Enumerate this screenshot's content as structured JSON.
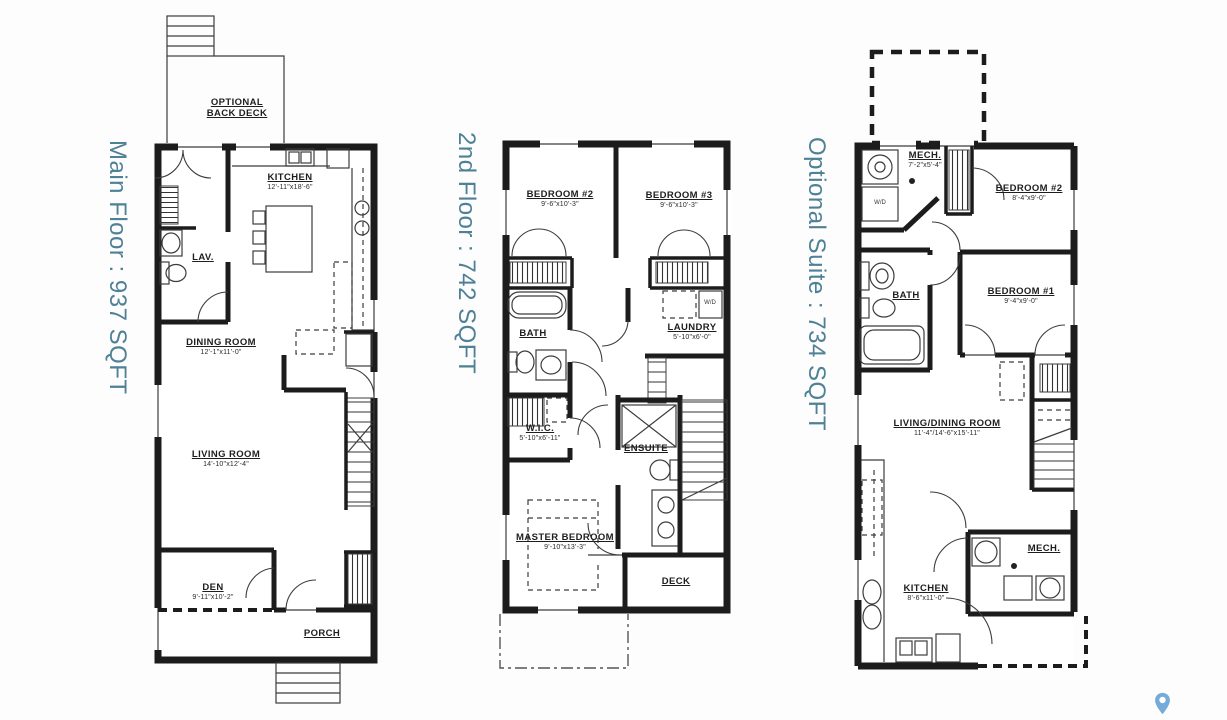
{
  "colors": {
    "accent": "#4e8096",
    "wall": "#1c1c1c",
    "pin": "#74abd8"
  },
  "wd_label": "W/D",
  "plans": [
    {
      "id": "main-floor",
      "label": "Main Floor : 937 SQFT",
      "rooms": [
        {
          "name": "OPTIONAL BACK DECK",
          "dims": ""
        },
        {
          "name": "KITCHEN",
          "dims": "12'-11\"x18'-6\""
        },
        {
          "name": "LAV.",
          "dims": ""
        },
        {
          "name": "DINING ROOM",
          "dims": "12'-1\"x11'-0\""
        },
        {
          "name": "LIVING ROOM",
          "dims": "14'-10\"x12'-4\""
        },
        {
          "name": "DEN",
          "dims": "9'-11\"x10'-2\""
        },
        {
          "name": "PORCH",
          "dims": ""
        }
      ]
    },
    {
      "id": "second-floor",
      "label": "2nd Floor : 742 SQFT",
      "rooms": [
        {
          "name": "BEDROOM #2",
          "dims": "9'-6\"x10'-3\""
        },
        {
          "name": "BEDROOM #3",
          "dims": "9'-6\"x10'-3\""
        },
        {
          "name": "BATH",
          "dims": ""
        },
        {
          "name": "LAUNDRY",
          "dims": "5'-10\"x6'-0\""
        },
        {
          "name": "W.I.C.",
          "dims": "5'-10\"x6'-11\""
        },
        {
          "name": "ENSUITE",
          "dims": ""
        },
        {
          "name": "MASTER BEDROOM",
          "dims": "9'-10\"x13'-3\""
        },
        {
          "name": "DECK",
          "dims": ""
        }
      ]
    },
    {
      "id": "optional-suite",
      "label": "Optional Suite : 734 SQFT",
      "rooms": [
        {
          "name": "MECH.",
          "dims": "7'-2\"x5'-4\""
        },
        {
          "name": "BEDROOM #2",
          "dims": "8'-4\"x9'-0\""
        },
        {
          "name": "BATH",
          "dims": ""
        },
        {
          "name": "BEDROOM #1",
          "dims": "9'-4\"x9'-0\""
        },
        {
          "name": "LIVING/DINING ROOM",
          "dims": "11'-4\"/14'-6\"x15'-11\""
        },
        {
          "name": "MECH.",
          "dims": ""
        },
        {
          "name": "KITCHEN",
          "dims": "8'-6\"x11'-0\""
        }
      ]
    }
  ]
}
